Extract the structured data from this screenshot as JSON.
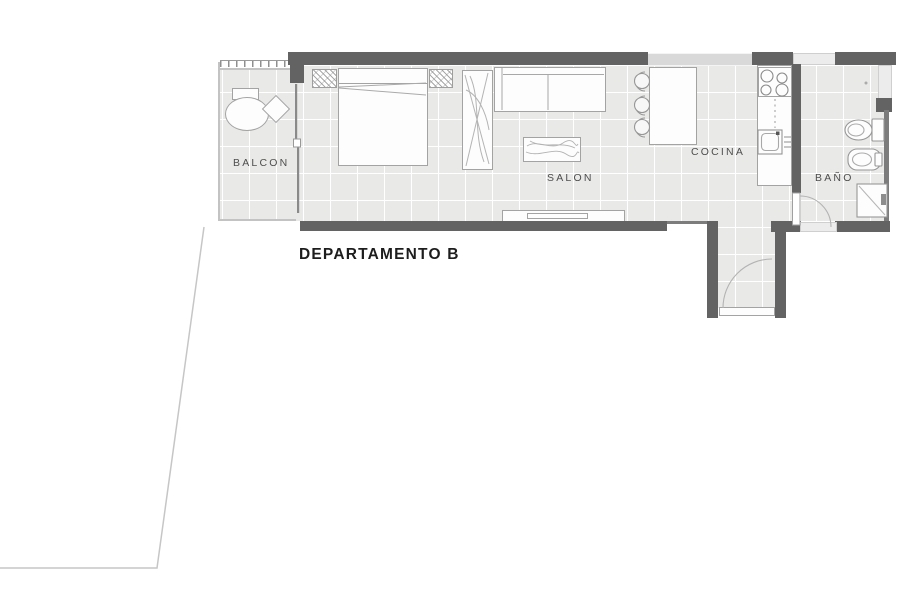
{
  "plan": {
    "title": "DEPARTAMENTO B",
    "rooms": {
      "balcon": "BALCON",
      "salon": "SALON",
      "cocina": "COCINA",
      "bano": "BAÑO"
    },
    "colors": {
      "wall": "#636363",
      "floor": "#e9e9e8",
      "tile_line": "#ffffff",
      "furniture_outline": "#a3a3a3",
      "door_arc": "#b3b3b3",
      "boundary_line": "#c6c6c6",
      "room_label": "#4e4e4e",
      "title": "#1d1d1d"
    }
  }
}
